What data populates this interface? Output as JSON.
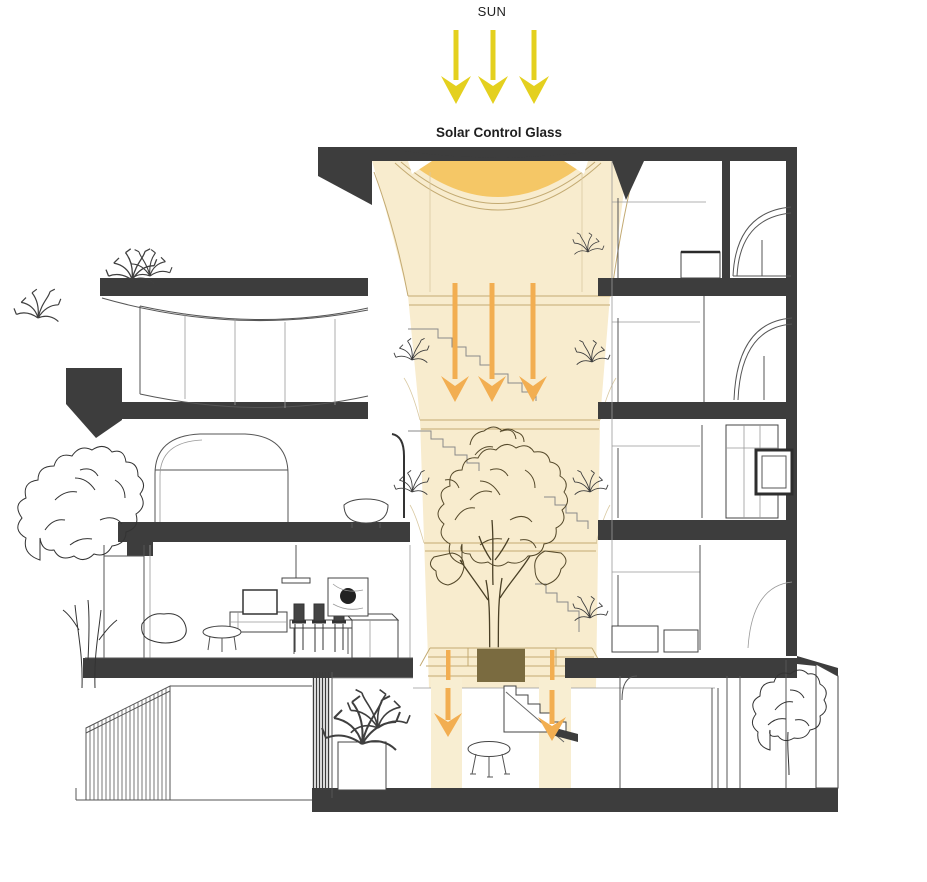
{
  "diagram": {
    "labels": {
      "sun": "SUN",
      "solar_control_glass": "Solar Control Glass"
    },
    "light_annotations": {
      "sun_rays": {
        "count": 3,
        "direction": "down"
      },
      "atrium_daylight_arrows": {
        "count": 3,
        "direction": "down"
      },
      "basement_daylight_arrows": {
        "count": 2,
        "direction": "down"
      },
      "basement_light_beams": {
        "count": 2
      }
    },
    "icons": {
      "sun_ray": "sun-ray-arrow-icon",
      "daylight": "daylight-arrow-icon"
    },
    "colors": {
      "poche": "#3d3d3d",
      "atrium_glow": "#f8ecce",
      "skylight_glass": "#f5c766",
      "sun_ray": "#e4d01f",
      "daylight_arrow": "#f2ae51",
      "light_beam": "#f8eed2",
      "atrium_line": "#c3aa72",
      "canopy_line": "#55492a",
      "planter": "#7a6b40",
      "text": "#1f1f1f",
      "background": "#ffffff"
    }
  }
}
